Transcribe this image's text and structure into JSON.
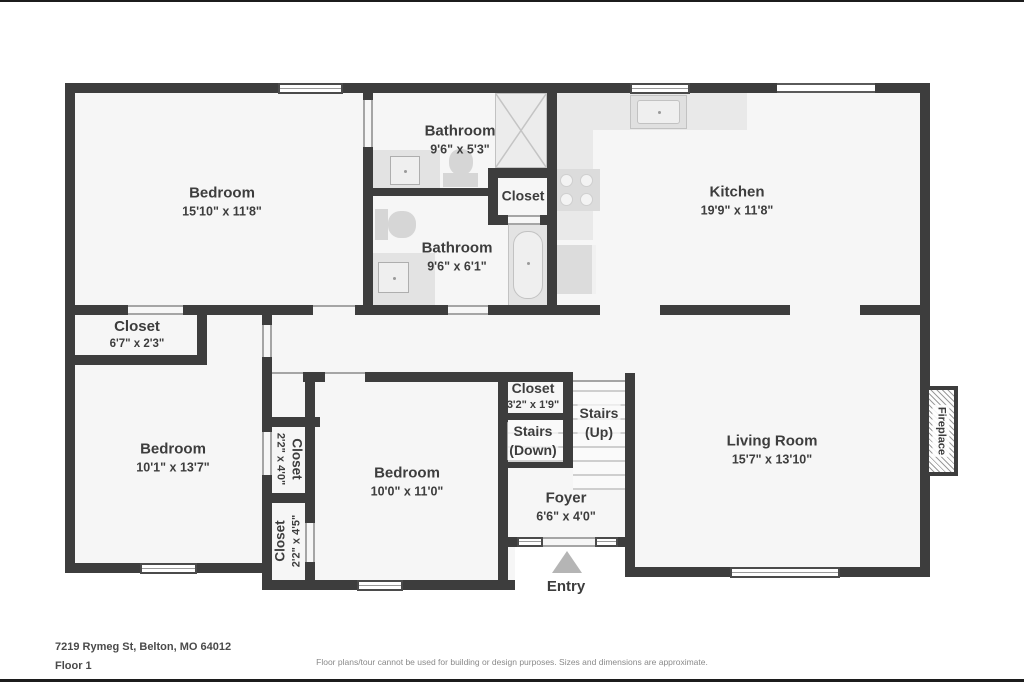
{
  "floorplan": {
    "rooms": {
      "bedroom1": {
        "name": "Bedroom",
        "dims": "15'10\" x 11'8\""
      },
      "bathroom1": {
        "name": "Bathroom",
        "dims": "9'6\" x 5'3\""
      },
      "closet_bath": {
        "name": "Closet"
      },
      "kitchen": {
        "name": "Kitchen",
        "dims": "19'9\" x 11'8\""
      },
      "bathroom2": {
        "name": "Bathroom",
        "dims": "9'6\" x 6'1\""
      },
      "closet1": {
        "name": "Closet",
        "dims": "6'7\" x 2'3\""
      },
      "bedroom2": {
        "name": "Bedroom",
        "dims": "10'1\" x 13'7\""
      },
      "closet2": {
        "name": "Closet",
        "dims": "2'2\" x 4'0\""
      },
      "closet3": {
        "name": "Closet",
        "dims": "2'2\" x 4'5\""
      },
      "bedroom3": {
        "name": "Bedroom",
        "dims": "10'0\" x 11'0\""
      },
      "closet4": {
        "name": "Closet",
        "dims": "3'2\" x 1'9\""
      },
      "stairs_down": {
        "line1": "Stairs",
        "line2": "(Down)"
      },
      "stairs_up": {
        "line1": "Stairs",
        "line2": "(Up)"
      },
      "foyer": {
        "name": "Foyer",
        "dims": "6'6\" x 4'0\""
      },
      "living": {
        "name": "Living Room",
        "dims": "15'7\" x 13'10\""
      },
      "fireplace": {
        "name": "Fireplace"
      },
      "entry": {
        "name": "Entry"
      }
    },
    "footer": {
      "address": "7219 Rymeg St, Belton, MO 64012",
      "floor": "Floor 1",
      "disclaimer": "Floor plans/tour cannot be used for building or design purposes. Sizes and dimensions are approximate."
    },
    "colors": {
      "wall": "#3d3d3d",
      "room_fill": "#f6f6f6",
      "fixture": "#e3e3e3",
      "text": "#3d3d3d"
    }
  }
}
